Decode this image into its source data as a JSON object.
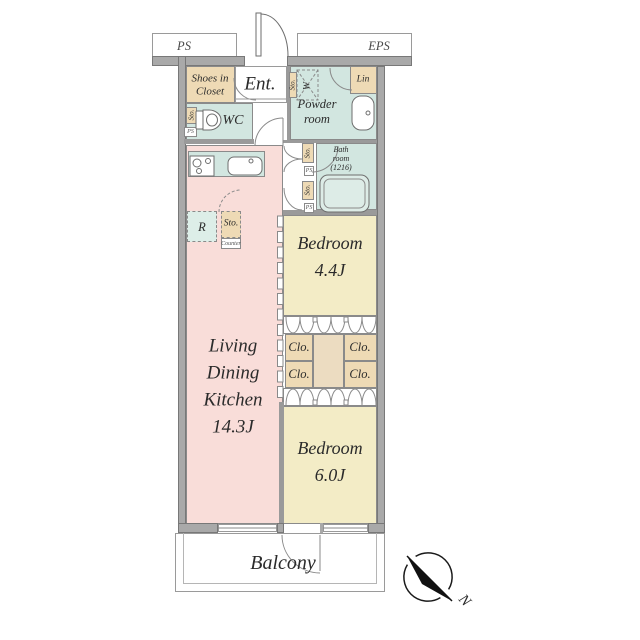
{
  "title": "Apartment floor plan 2LDK",
  "labels": {
    "ps": "PS",
    "eps": "EPS",
    "ent": "Ent.",
    "shoes1": "Shoes in",
    "shoes2": "Closet",
    "wc": "WC",
    "powder1": "Powder",
    "powder2": "room",
    "lin": "Lin",
    "w": "W",
    "sto": "Sto.",
    "ps_small": "PS",
    "bath1": "Bath",
    "bath2": "room",
    "bath3": "(1216)",
    "bedroom1_1": "Bedroom",
    "bedroom1_2": "4.4J",
    "clo": "Clo.",
    "ldk1": "Living",
    "ldk2": "Dining",
    "ldk3": "Kitchen",
    "ldk4": "14.3J",
    "bedroom2_1": "Bedroom",
    "bedroom2_2": "6.0J",
    "r": "R",
    "counter": "Counter",
    "balcony": "Balcony",
    "north": "N"
  },
  "rooms": [
    {
      "name": "Living Dining Kitchen",
      "size": "14.3J"
    },
    {
      "name": "Bedroom",
      "size": "4.4J"
    },
    {
      "name": "Bedroom",
      "size": "6.0J"
    },
    {
      "name": "Bath room",
      "size": "(1216)"
    },
    {
      "name": "Powder room",
      "size": ""
    },
    {
      "name": "WC",
      "size": ""
    },
    {
      "name": "Ent.",
      "size": ""
    },
    {
      "name": "Shoes in Closet",
      "size": ""
    },
    {
      "name": "Balcony",
      "size": ""
    }
  ],
  "colors": {
    "wall": "#a9a9a9",
    "wall_edge": "#787878",
    "ldk_pink": "#f9ddd9",
    "wet_teal": "#d2e6e0",
    "bedroom_cream": "#f3ecc6",
    "closet_tan": "#eedab5",
    "closet_mid_tan": "#ecdcc1",
    "line_gray": "#8a8a8a",
    "text": "#2b2b2b"
  }
}
